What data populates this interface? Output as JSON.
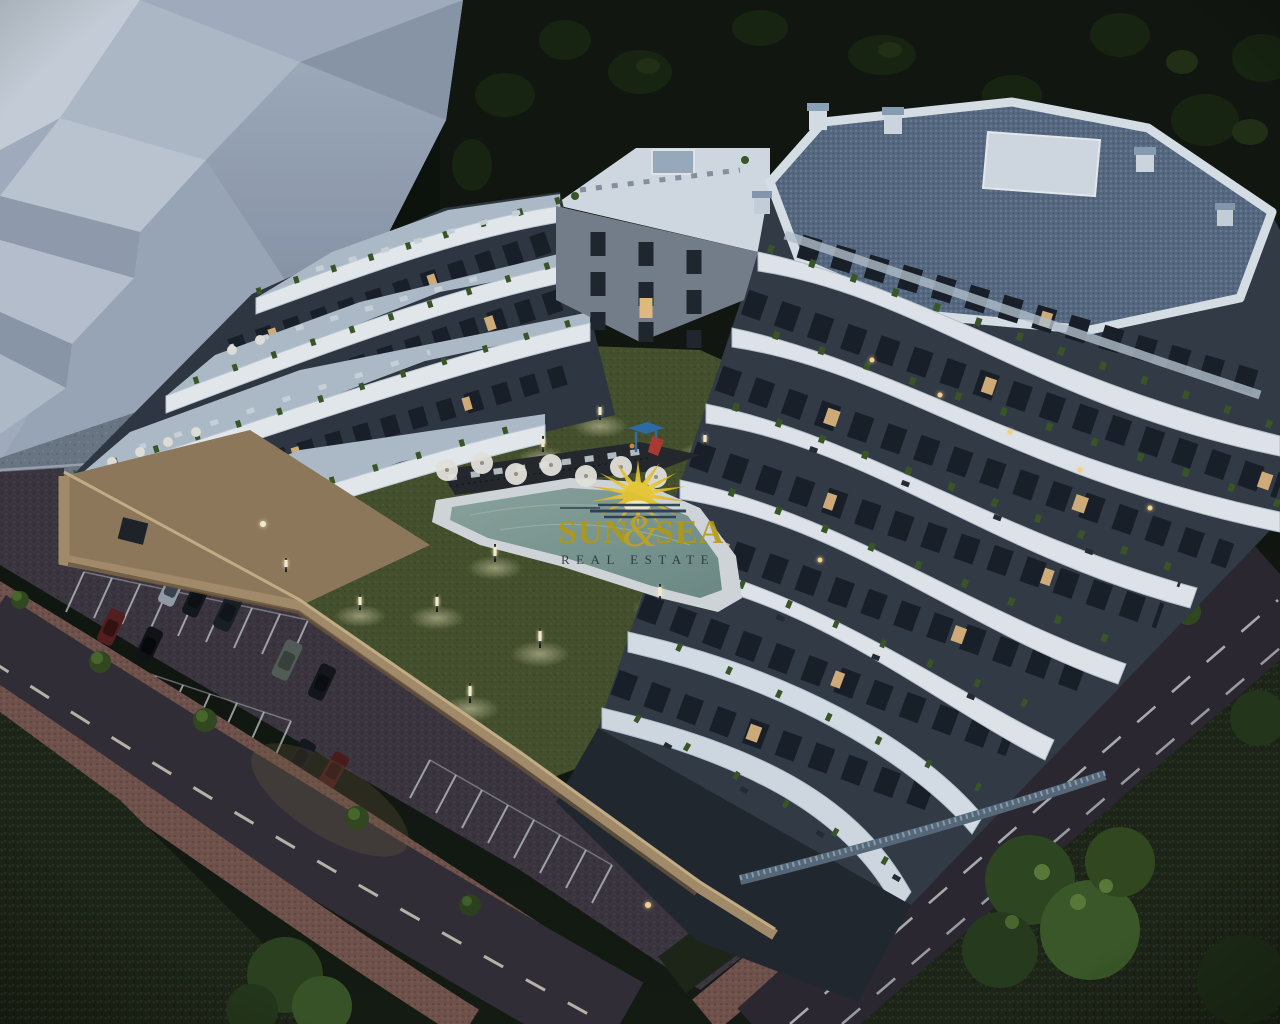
{
  "scene": {
    "type": "3d-architectural-render",
    "description": "Aerial dusk render of a terraced white apartment complex with courtyard lawn, swimming pool, parking lot and perimeter streets"
  },
  "watermark": {
    "brand_word1": "SUN",
    "brand_ampersand": "&",
    "brand_word2": "SEA",
    "tagline": "REAL ESTATE",
    "brand_color": "#b5980f",
    "tagline_color": "#242b34",
    "sun_icon_color": "#e7c42f"
  },
  "palette": {
    "night_sky": "#0d120c",
    "hillside": "#131a10",
    "massing_block": "#aab6c6",
    "plaza_paving": "#6e7987",
    "building_white": "#e9edf2",
    "facade_dark": "#343c47",
    "window_lit": "#e9c183",
    "roof_deck": "#5a6c83",
    "terrace_deck": "#b5c2cf",
    "lawn": "#49542e",
    "pool_water": "#7b9a93",
    "pool_deck": "#d9dde0",
    "asphalt_parking": "#3d3640",
    "asphalt_street": "#332e36",
    "lane_dash": "#d8d1c3",
    "sidewalk_red": "#7d5a52",
    "perimeter_wall_tan": "#a8906c",
    "foliage": "#2f4720",
    "bollard_light": "#fff3cf"
  }
}
